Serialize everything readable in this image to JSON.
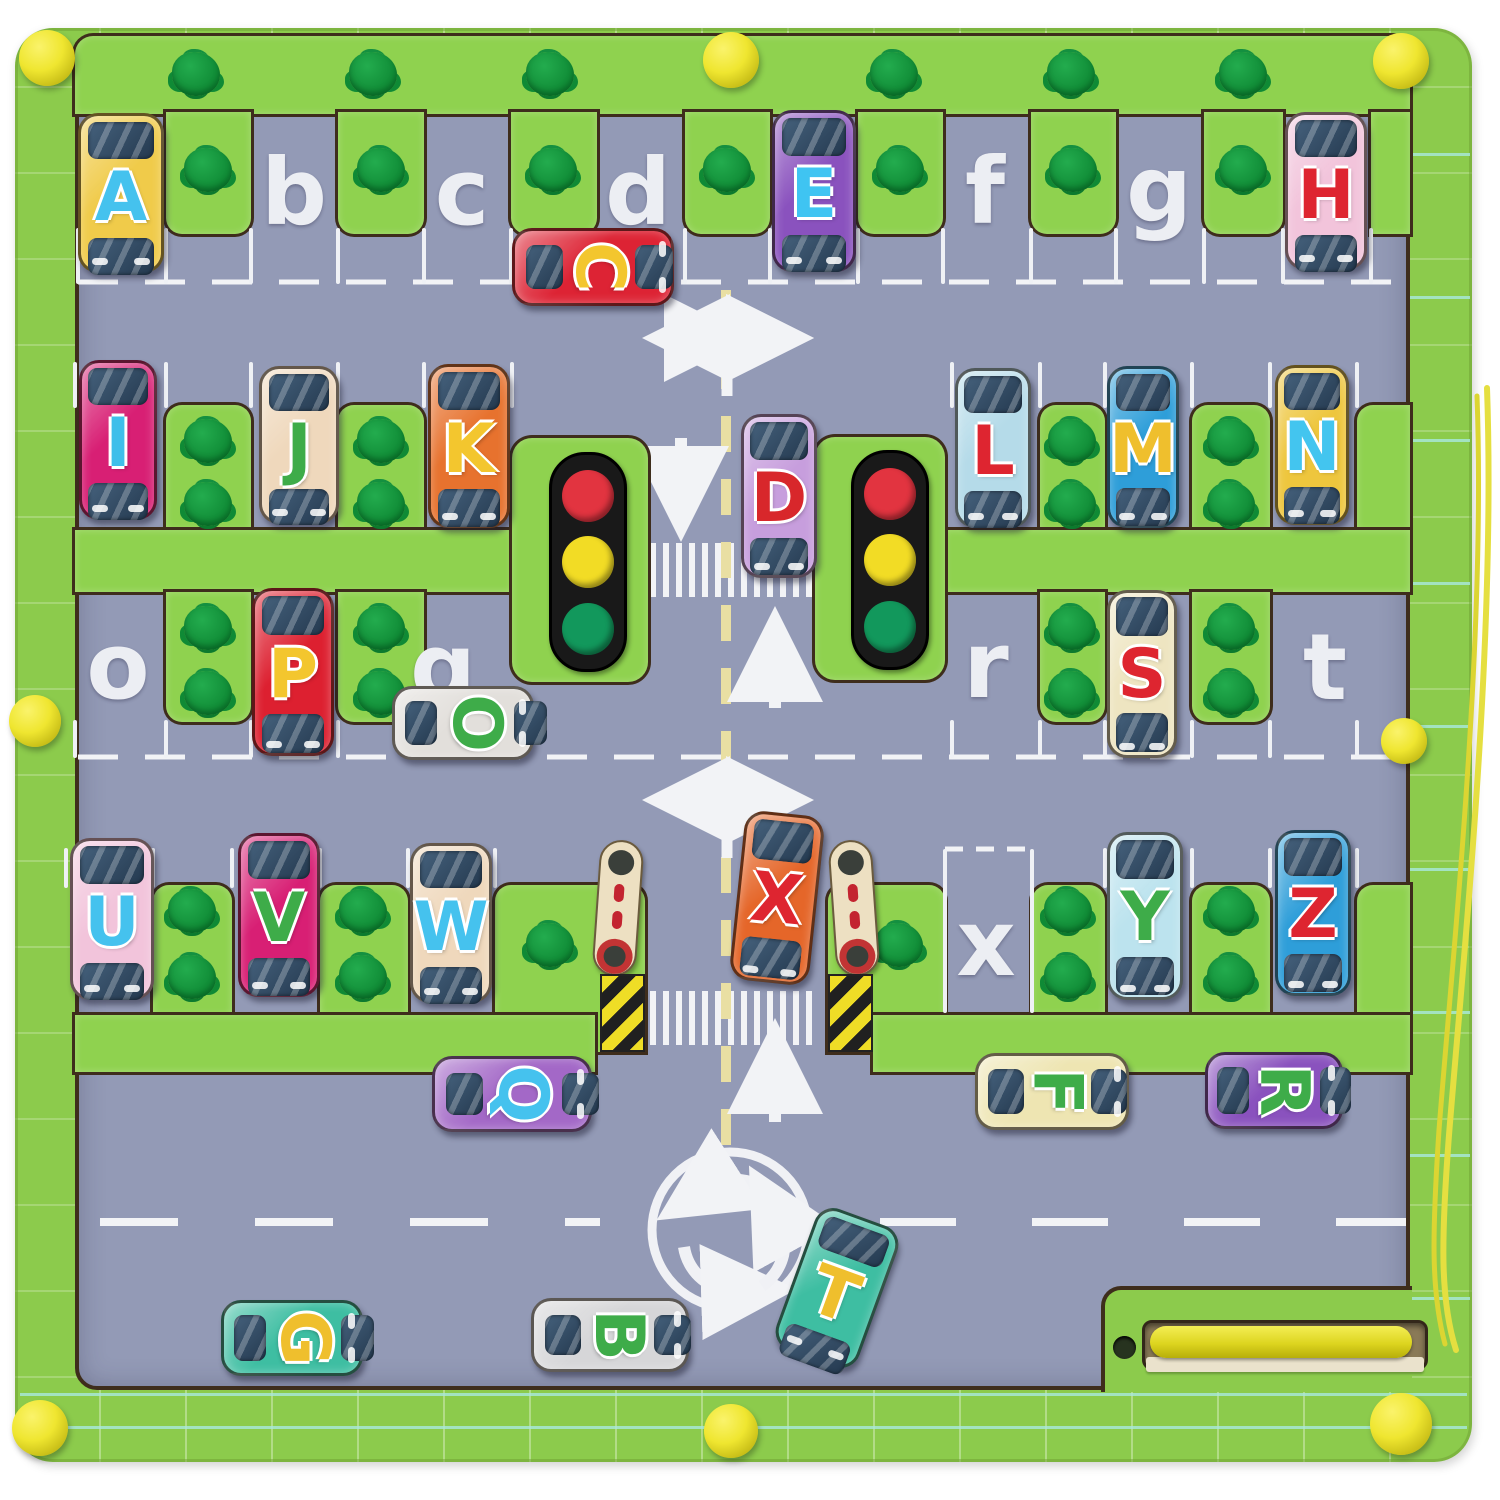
{
  "board": {
    "title": "magnetic-alphabet-maze-board",
    "frame_color": "#8CCB4C",
    "path_color": "#8FD24F",
    "road_color": "#939AB6",
    "tree_color": "#0F8A35",
    "knob_color": "#EFE630",
    "groove_color": "#3E2D1C",
    "marking_color": "#F2F3F6",
    "centerline_color": "#E9DFA3"
  },
  "parking_spots": [
    {
      "letter": "b",
      "x": 294,
      "y": 193
    },
    {
      "letter": "c",
      "x": 462,
      "y": 193
    },
    {
      "letter": "d",
      "x": 638,
      "y": 193
    },
    {
      "letter": "f",
      "x": 985,
      "y": 192
    },
    {
      "letter": "g",
      "x": 1159,
      "y": 190
    },
    {
      "letter": "o",
      "x": 118,
      "y": 667
    },
    {
      "letter": "q",
      "x": 443,
      "y": 668
    },
    {
      "letter": "r",
      "x": 986,
      "y": 666
    },
    {
      "letter": "t",
      "x": 1325,
      "y": 668
    },
    {
      "letter": "x",
      "x": 986,
      "y": 944
    }
  ],
  "cars": [
    {
      "letter": "A",
      "body": "#F0CB4A",
      "ink": "#45C2EE",
      "x": 78,
      "y": 113,
      "w": 86,
      "h": 160,
      "orient": "v",
      "rot": 0
    },
    {
      "letter": "C",
      "body": "#DD2334",
      "ink": "#F3C62E",
      "x": 512,
      "y": 228,
      "w": 162,
      "h": 78,
      "orient": "h",
      "rot": 0
    },
    {
      "letter": "E",
      "body": "#8A52BE",
      "ink": "#3FC4F2",
      "x": 772,
      "y": 110,
      "w": 84,
      "h": 162,
      "orient": "v",
      "rot": 0
    },
    {
      "letter": "H",
      "body": "#F2C4DB",
      "ink": "#DE2530",
      "x": 1285,
      "y": 112,
      "w": 82,
      "h": 158,
      "orient": "v",
      "rot": 0
    },
    {
      "letter": "I",
      "body": "#D81F74",
      "ink": "#3FBFEA",
      "x": 79,
      "y": 360,
      "w": 78,
      "h": 160,
      "orient": "v",
      "rot": 0
    },
    {
      "letter": "J",
      "body": "#EFD8BC",
      "ink": "#3EAC49",
      "x": 259,
      "y": 366,
      "w": 80,
      "h": 158,
      "orient": "v",
      "rot": 0
    },
    {
      "letter": "K",
      "body": "#E7722E",
      "ink": "#F3C62E",
      "x": 428,
      "y": 364,
      "w": 82,
      "h": 164,
      "orient": "v",
      "rot": 0
    },
    {
      "letter": "D",
      "body": "#C79EDD",
      "ink": "#D8272B",
      "x": 741,
      "y": 414,
      "w": 76,
      "h": 164,
      "orient": "v",
      "rot": 0
    },
    {
      "letter": "L",
      "body": "#B5DBE9",
      "ink": "#DE2530",
      "x": 955,
      "y": 368,
      "w": 76,
      "h": 160,
      "orient": "v",
      "rot": 0
    },
    {
      "letter": "M",
      "body": "#2E9ED9",
      "ink": "#EFBF2D",
      "x": 1107,
      "y": 366,
      "w": 72,
      "h": 162,
      "orient": "v",
      "rot": 0
    },
    {
      "letter": "N",
      "body": "#EEC63D",
      "ink": "#43C5EF",
      "x": 1275,
      "y": 365,
      "w": 74,
      "h": 160,
      "orient": "v",
      "rot": 0
    },
    {
      "letter": "P",
      "body": "#DD2030",
      "ink": "#F3C62E",
      "x": 252,
      "y": 588,
      "w": 82,
      "h": 168,
      "orient": "v",
      "rot": 0
    },
    {
      "letter": "S",
      "body": "#EEE5C1",
      "ink": "#DE2530",
      "x": 1107,
      "y": 590,
      "w": 70,
      "h": 168,
      "orient": "v",
      "rot": 0
    },
    {
      "letter": "O",
      "body": "#E2DFDB",
      "ink": "#3EAC49",
      "x": 392,
      "y": 686,
      "w": 142,
      "h": 74,
      "orient": "h",
      "rot": 0
    },
    {
      "letter": "U",
      "body": "#F2C4DB",
      "ink": "#45C2EE",
      "x": 70,
      "y": 838,
      "w": 84,
      "h": 162,
      "orient": "v",
      "rot": 0
    },
    {
      "letter": "V",
      "body": "#D81F74",
      "ink": "#3EAC49",
      "x": 238,
      "y": 833,
      "w": 82,
      "h": 164,
      "orient": "v",
      "rot": 0
    },
    {
      "letter": "W",
      "body": "#EFD8BC",
      "ink": "#45C2EE",
      "x": 410,
      "y": 843,
      "w": 82,
      "h": 160,
      "orient": "v",
      "rot": 0
    },
    {
      "letter": "X",
      "body": "#E56629",
      "ink": "#DE2530",
      "x": 737,
      "y": 813,
      "w": 80,
      "h": 170,
      "orient": "v",
      "rot": 6
    },
    {
      "letter": "Y",
      "body": "#BCE3EE",
      "ink": "#3EAC49",
      "x": 1107,
      "y": 832,
      "w": 76,
      "h": 168,
      "orient": "v",
      "rot": 0
    },
    {
      "letter": "Z",
      "body": "#2E9ED9",
      "ink": "#DE2530",
      "x": 1275,
      "y": 830,
      "w": 76,
      "h": 166,
      "orient": "v",
      "rot": 0
    },
    {
      "letter": "Q",
      "body": "#A368C7",
      "ink": "#45C2EE",
      "x": 432,
      "y": 1056,
      "w": 160,
      "h": 76,
      "orient": "h",
      "rot": 0
    },
    {
      "letter": "F",
      "body": "#EEE5B2",
      "ink": "#3EAC49",
      "x": 975,
      "y": 1053,
      "w": 154,
      "h": 77,
      "orient": "h",
      "rot": 0
    },
    {
      "letter": "R",
      "body": "#8A52BE",
      "ink": "#3EAC49",
      "x": 1205,
      "y": 1052,
      "w": 138,
      "h": 77,
      "orient": "h",
      "rot": 0
    },
    {
      "letter": "T",
      "body": "#3EBEA2",
      "ink": "#EFBF2D",
      "x": 793,
      "y": 1213,
      "w": 88,
      "h": 150,
      "orient": "v",
      "rot": 20
    },
    {
      "letter": "B",
      "body": "#D6D6D8",
      "ink": "#3EAC49",
      "x": 531,
      "y": 1298,
      "w": 158,
      "h": 74,
      "orient": "h",
      "rot": 0
    },
    {
      "letter": "G",
      "body": "#3EBEA2",
      "ink": "#EFBF2D",
      "x": 221,
      "y": 1300,
      "w": 142,
      "h": 76,
      "orient": "h",
      "rot": 0
    }
  ],
  "walls": [
    [
      75,
      36,
      1335,
      78,
      "18px 18px 0 0"
    ],
    [
      166,
      112,
      85,
      122,
      "0 0 16px 16px"
    ],
    [
      338,
      112,
      86,
      122,
      "0 0 16px 16px"
    ],
    [
      511,
      112,
      86,
      122,
      "0 0 16px 16px"
    ],
    [
      685,
      112,
      85,
      122,
      "0 0 16px 16px"
    ],
    [
      858,
      112,
      85,
      122,
      "0 0 16px 16px"
    ],
    [
      1031,
      112,
      85,
      122,
      "0 0 16px 16px"
    ],
    [
      1204,
      112,
      79,
      122,
      "0 0 16px 16px"
    ],
    [
      1371,
      112,
      39,
      122,
      "0"
    ],
    [
      166,
      405,
      85,
      125,
      "16px 16px 0 0"
    ],
    [
      338,
      405,
      86,
      125,
      "16px 16px 0 0"
    ],
    [
      1040,
      405,
      65,
      125,
      "16px 16px 0 0"
    ],
    [
      1192,
      405,
      78,
      125,
      "16px 16px 0 0"
    ],
    [
      1357,
      405,
      53,
      125,
      "16px 0 0 0"
    ],
    [
      75,
      530,
      437,
      62,
      "0"
    ],
    [
      945,
      530,
      465,
      62,
      "0"
    ],
    [
      512,
      438,
      136,
      244,
      "20px"
    ],
    [
      815,
      437,
      130,
      243,
      "20px"
    ],
    [
      166,
      592,
      85,
      130,
      "0 0 16px 16px"
    ],
    [
      338,
      592,
      86,
      130,
      "0 0 16px 16px"
    ],
    [
      1040,
      592,
      65,
      130,
      "0 0 16px 16px"
    ],
    [
      1192,
      592,
      78,
      130,
      "0 0 16px 16px"
    ],
    [
      153,
      885,
      79,
      130,
      "16px 16px 0 0"
    ],
    [
      320,
      885,
      88,
      130,
      "16px 16px 0 0"
    ],
    [
      1032,
      885,
      73,
      130,
      "16px 16px 0 0"
    ],
    [
      1192,
      885,
      78,
      130,
      "16px 16px 0 0"
    ],
    [
      1357,
      885,
      53,
      130,
      "16px 0 0 0"
    ],
    [
      495,
      885,
      150,
      167,
      "16px 16px 0 0"
    ],
    [
      828,
      885,
      117,
      167,
      "16px 16px 0 0"
    ],
    [
      75,
      1015,
      520,
      57,
      "0"
    ],
    [
      873,
      1015,
      537,
      57,
      "0"
    ]
  ],
  "trees": [
    [
      196,
      74
    ],
    [
      373,
      74
    ],
    [
      550,
      74
    ],
    [
      894,
      74
    ],
    [
      1071,
      74
    ],
    [
      1243,
      74
    ],
    [
      208,
      170
    ],
    [
      381,
      170
    ],
    [
      553,
      170
    ],
    [
      727,
      170
    ],
    [
      900,
      170
    ],
    [
      1073,
      170
    ],
    [
      1243,
      170
    ],
    [
      208,
      441
    ],
    [
      208,
      504
    ],
    [
      381,
      441
    ],
    [
      381,
      504
    ],
    [
      1072,
      441
    ],
    [
      1072,
      504
    ],
    [
      1231,
      441
    ],
    [
      1231,
      504
    ],
    [
      208,
      628
    ],
    [
      208,
      693
    ],
    [
      381,
      628
    ],
    [
      381,
      693
    ],
    [
      1072,
      628
    ],
    [
      1072,
      693
    ],
    [
      1231,
      628
    ],
    [
      1231,
      693
    ],
    [
      192,
      911
    ],
    [
      192,
      977
    ],
    [
      363,
      911
    ],
    [
      363,
      977
    ],
    [
      550,
      945
    ],
    [
      899,
      945
    ],
    [
      1068,
      911
    ],
    [
      1068,
      977
    ],
    [
      1231,
      911
    ],
    [
      1231,
      977
    ]
  ],
  "bay_lines": [
    {
      "y": 228,
      "h": 56,
      "xs": [
        78,
        166,
        251,
        338,
        424,
        511,
        597,
        685,
        770,
        858,
        943,
        1031,
        1116,
        1204,
        1283,
        1371
      ]
    },
    {
      "y": 362,
      "h": 46,
      "xs": [
        75,
        166,
        251,
        338,
        424,
        512,
        952,
        1040,
        1105,
        1192,
        1270,
        1357
      ]
    },
    {
      "y": 720,
      "h": 38,
      "xs": [
        75,
        166,
        251,
        338,
        424,
        512,
        952,
        1040,
        1105,
        1192,
        1270,
        1357
      ]
    },
    {
      "y": 848,
      "h": 40,
      "xs": [
        66,
        153,
        232,
        320,
        408,
        495,
        1105,
        1192,
        1270,
        1357
      ]
    },
    {
      "y": 849,
      "h": 164,
      "xs": [
        945,
        1032
      ]
    }
  ],
  "traffic_lights": [
    {
      "x": 549,
      "y": 452,
      "lamps": [
        "#E23440",
        "#F2DC25",
        "#12985C"
      ]
    },
    {
      "x": 851,
      "y": 450,
      "lamps": [
        "#E23440",
        "#F2DC25",
        "#12985C"
      ]
    }
  ],
  "barriers": {
    "posts": [
      {
        "x": 596,
        "y": 840,
        "rot": 4
      },
      {
        "x": 832,
        "y": 840,
        "rot": -4
      }
    ],
    "bases": [
      {
        "x": 600,
        "y": 974
      },
      {
        "x": 828,
        "y": 974
      }
    ]
  },
  "knobs": [
    [
      47,
      58,
      56
    ],
    [
      731,
      60,
      56
    ],
    [
      1401,
      61,
      56
    ],
    [
      35,
      721,
      52
    ],
    [
      1404,
      741,
      46
    ],
    [
      40,
      1428,
      56
    ],
    [
      731,
      1431,
      54
    ],
    [
      1401,
      1424,
      62
    ]
  ]
}
